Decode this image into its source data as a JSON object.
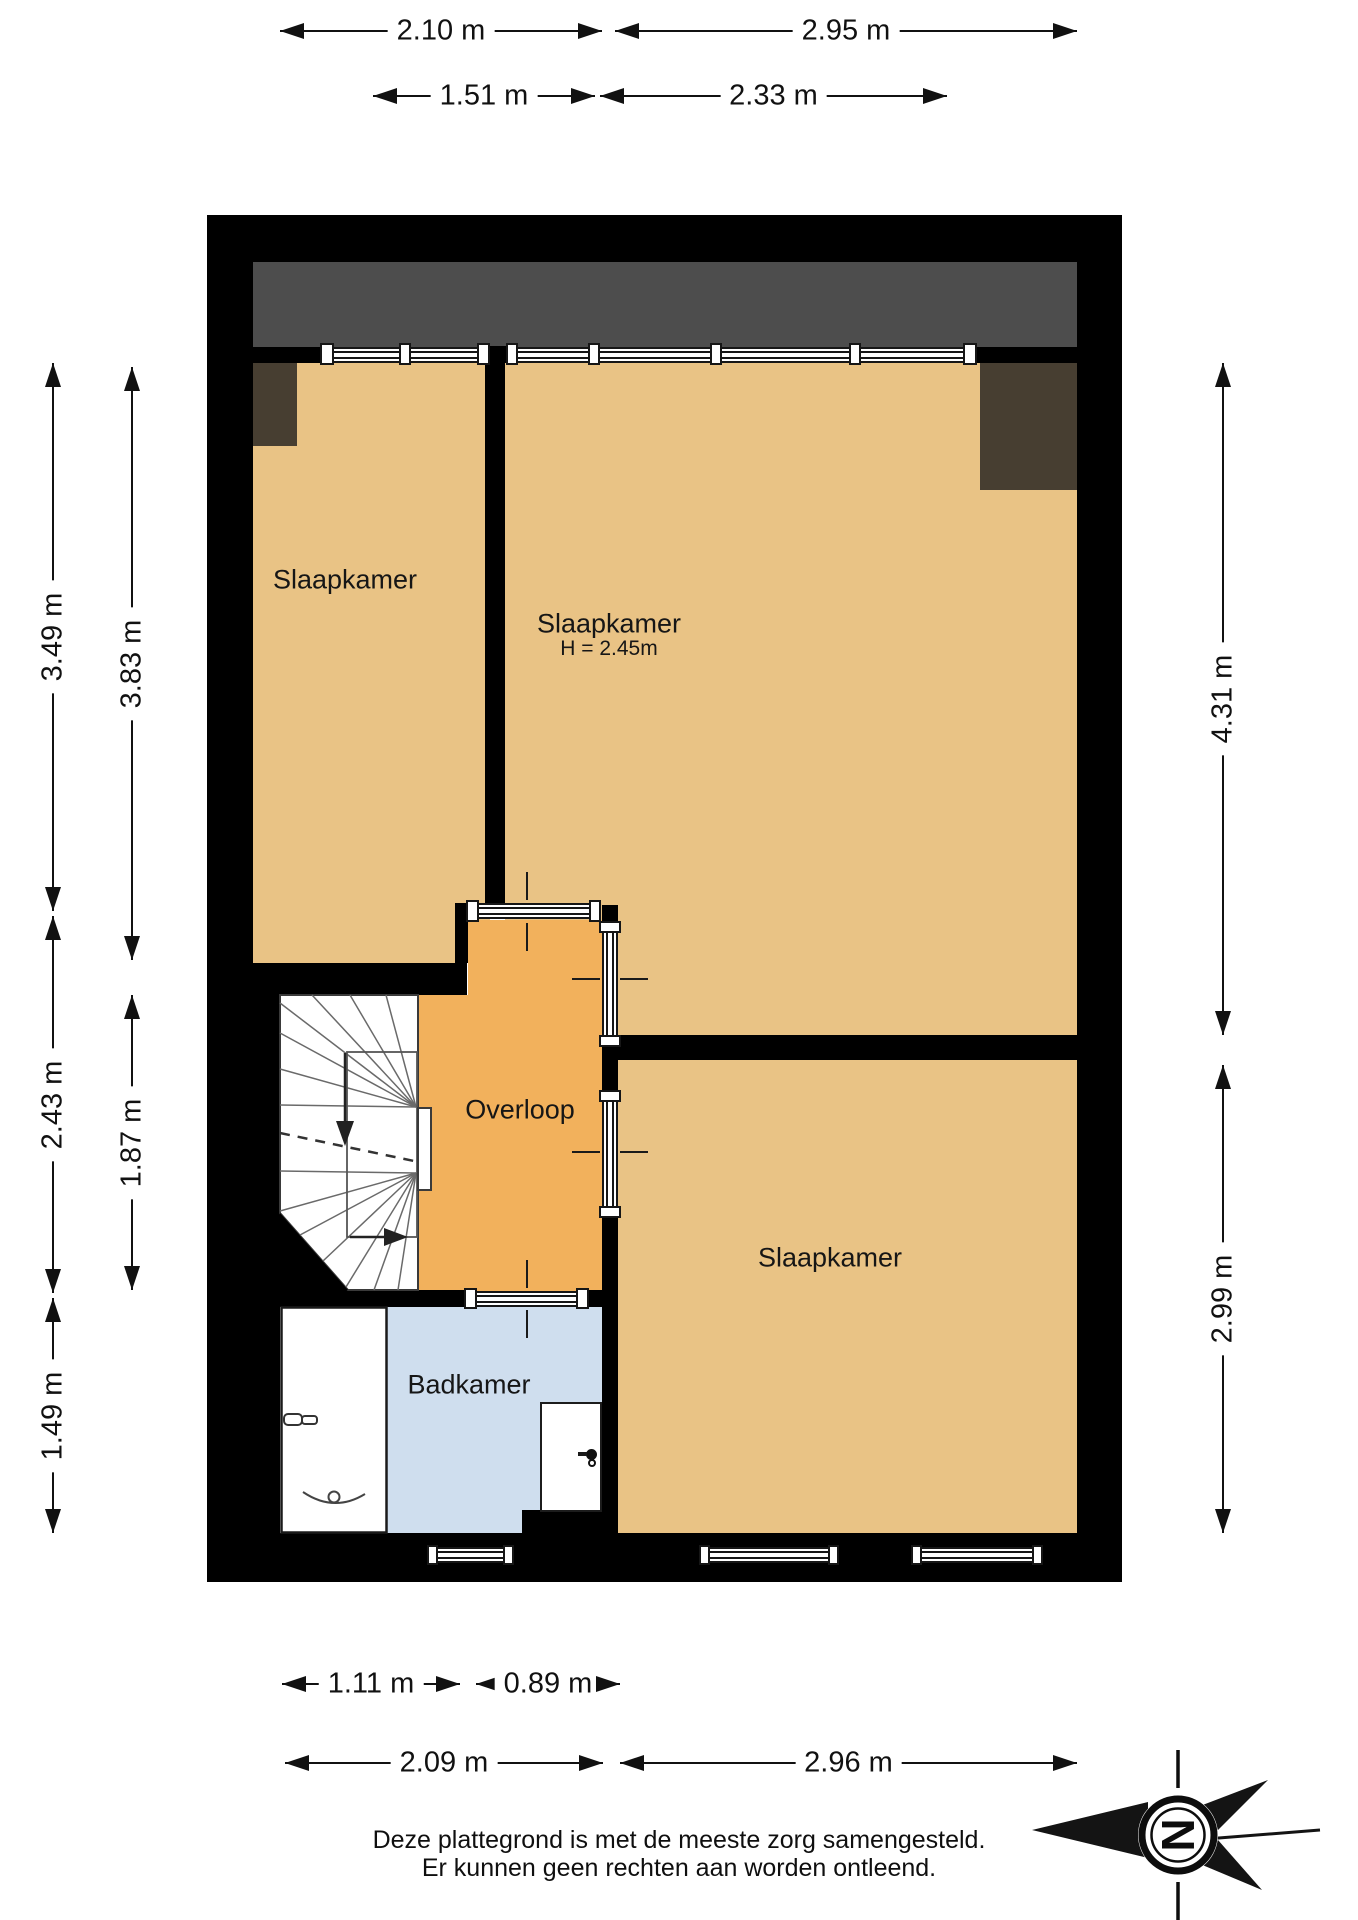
{
  "plan": {
    "type": "floorplan",
    "rooms": [
      {
        "id": "slaapkamer-left",
        "label": "Slaapkamer"
      },
      {
        "id": "slaapkamer-right",
        "label": "Slaapkamer",
        "height_note": "H = 2.45m"
      },
      {
        "id": "slaapkamer-bottom",
        "label": "Slaapkamer"
      },
      {
        "id": "overloop",
        "label": "Overloop"
      },
      {
        "id": "badkamer",
        "label": "Badkamer"
      }
    ],
    "colors": {
      "wall": "#000000",
      "bedroom_floor": "#e9c385",
      "landing_floor": "#f2b15c",
      "bathroom_floor": "#cfdeee",
      "roof_zone": "#4d4d4d",
      "low_ceiling_zone": "#473e31"
    }
  },
  "dimensions": {
    "top_outer": [
      "2.10 m",
      "2.95 m"
    ],
    "top_inner": [
      "1.51 m",
      "2.33 m"
    ],
    "left_outer": [
      "3.49 m",
      "2.43 m",
      "1.49 m"
    ],
    "left_inner": [
      "3.83 m",
      "1.87 m"
    ],
    "right": [
      "4.31 m",
      "2.99 m"
    ],
    "bottom_inner": [
      "1.11 m",
      "0.89 m"
    ],
    "bottom_outer": [
      "2.09 m",
      "2.96 m"
    ]
  },
  "compass": {
    "letter": "N"
  },
  "disclaimer": {
    "line1": "Deze plattegrond is met de meeste zorg samengesteld.",
    "line2": "Er kunnen geen rechten aan worden ontleend."
  }
}
